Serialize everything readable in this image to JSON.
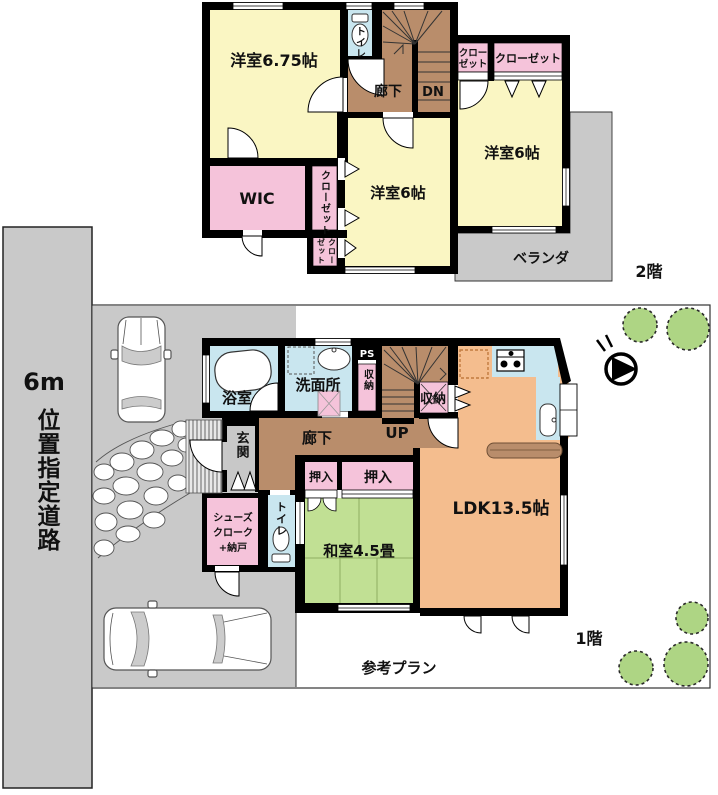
{
  "f2": {
    "floor_label": "2階",
    "room675": "洋室6.75帖",
    "toilet": "トイレ",
    "hall": "廊下",
    "dn": "DN",
    "closet_s1": "クロー",
    "closet_s2": "ゼット",
    "closet_wide": "クローゼット",
    "room6_right": "洋室6帖",
    "room6_center": "洋室6帖",
    "wic": "WIC",
    "closet_strip": "クローゼット",
    "closet_b1": "クロー",
    "closet_b2": "ゼット",
    "veranda": "ベランダ"
  },
  "f1": {
    "floor_label": "1階",
    "bath": "浴室",
    "washroom": "洗面所",
    "ps": "PS",
    "storage_left": "収納",
    "storage_right": "収納",
    "up": "UP",
    "hall": "廊下",
    "entrance": "玄関",
    "shoes1": "シューズ",
    "shoes2": "クローク",
    "shoes3": "+納戸",
    "toilet": "トイレ",
    "oshiire_small": "押入",
    "oshiire_large": "押入",
    "washitsu": "和室4.5畳",
    "ldk": "LDK13.5帖"
  },
  "site": {
    "road_width": "6m",
    "road_name": "位置指定道路",
    "plan_note": "参考プラン"
  },
  "colors": {
    "wall": "#000000",
    "western_room": "#FAF6C3",
    "closet_pink": "#F5C3DA",
    "water_blue": "#C9E6EF",
    "hall_brown": "#B98D6B",
    "ldk_orange": "#F4BD8E",
    "tatami_green": "#C1E094",
    "road_gray": "#C9C9C9",
    "tree_green": "#AED584"
  }
}
